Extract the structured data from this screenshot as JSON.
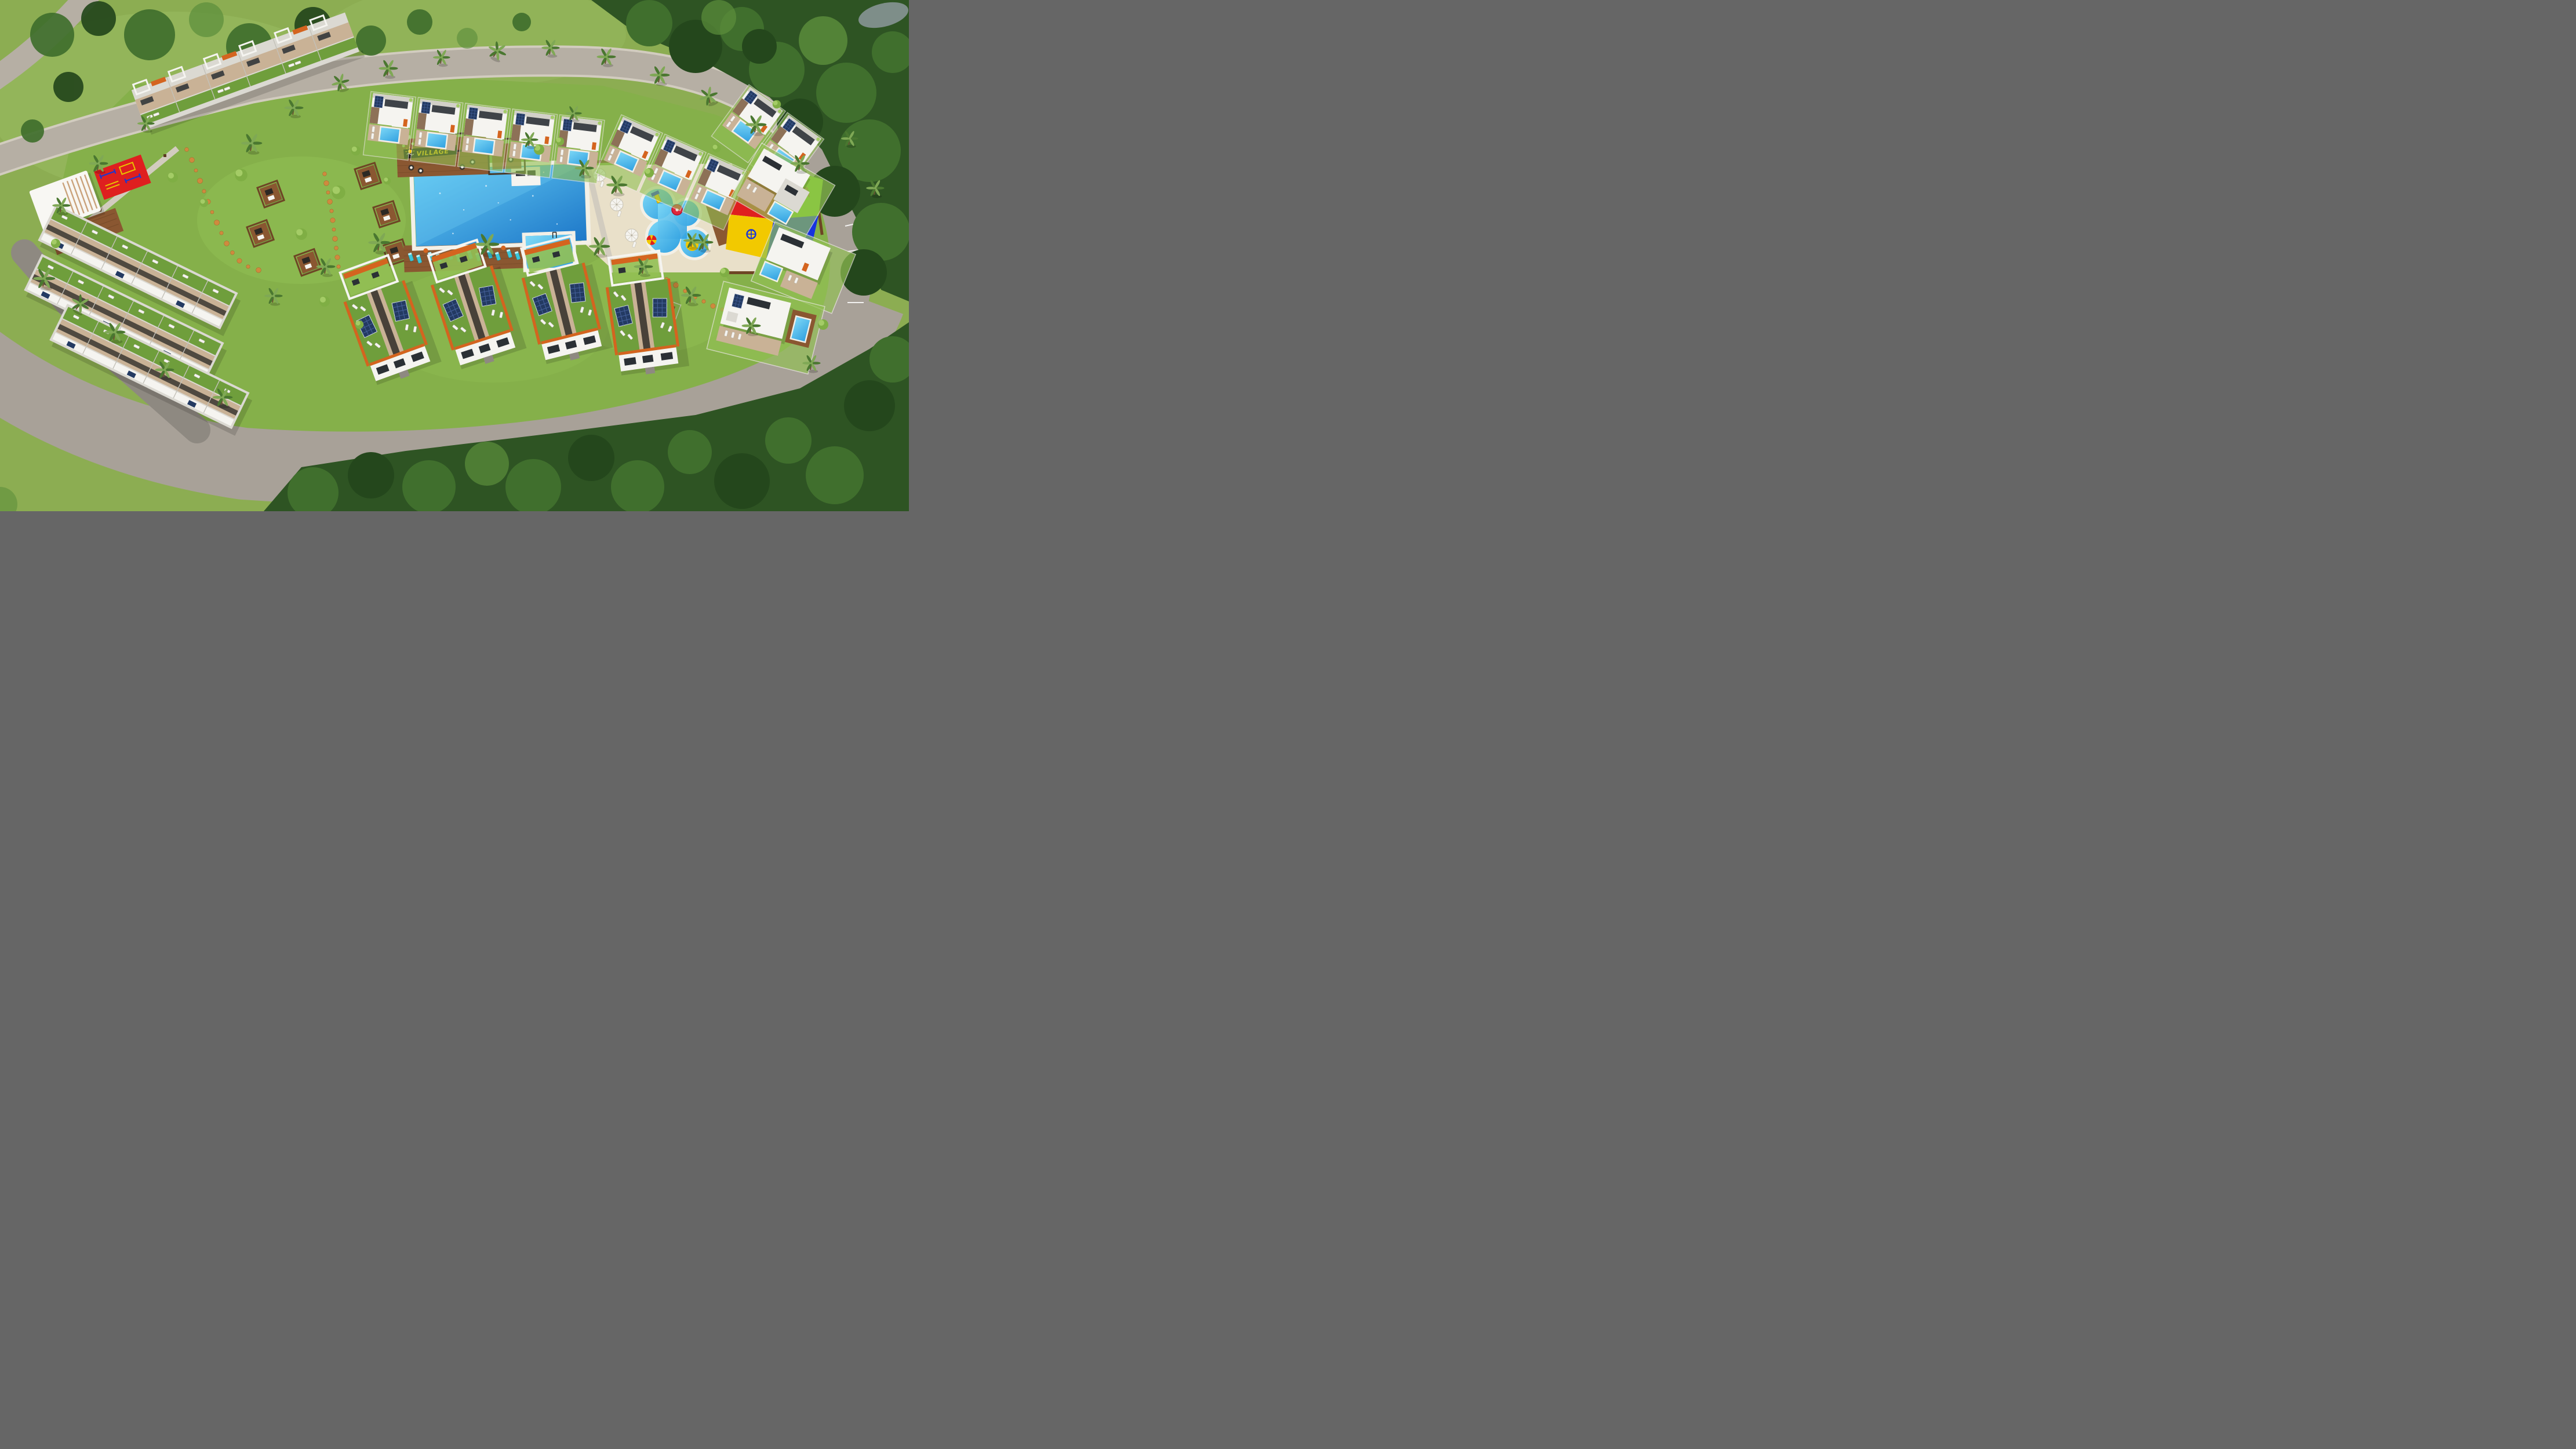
{
  "meta": {
    "kind": "aerial-3d-masterplan-render",
    "subject": "holiday village resort with townhouses, villas, communal pool, kids aqua zone and playground, ringed by a loop road and forest"
  },
  "signs": {
    "pool_bar": {
      "logo": "sun-script-logo",
      "text": "VILLAGE"
    }
  },
  "palette": {
    "meadow": "#8cad52",
    "meadowLight": "#9cbf63",
    "lawn": "#85b04a",
    "lawnBright": "#92c054",
    "forestDark": "#2e5423",
    "forestMid": "#406f2d",
    "forestLight": "#5d8f3c",
    "forestDeep": "#24471c",
    "road": "#b6afa4",
    "roadWide": "#a8a198",
    "roadDark": "#8e8981",
    "sidewalk": "#d2ccbf",
    "sand": "#e9e0c9",
    "poolDeep": "#1e78c9",
    "poolLight": "#63ccf4",
    "poolRim": "#f3f0e7",
    "wood": "#8a5731",
    "woodDark": "#6e4525",
    "deckLight": "#c9b296",
    "white": "#f5f4f0",
    "wall": "#dbd9d2",
    "glass": "#2b3035",
    "orange": "#d4641f",
    "solar": "#233a62",
    "greenRoof": "#6f9e3c",
    "tealLounger": "#3cc6d8",
    "playRed": "#df1f1f",
    "playYellow": "#f2c900",
    "playGreen": "#78d21e",
    "playBlue": "#1733df",
    "mushroom": "#e0273c",
    "logPath": "#cf8a3e",
    "palmDark": "#4a7730",
    "palmLight": "#7fa855",
    "trunk": "#6b5233",
    "bush1": "#7fae44",
    "bush2": "#a4cc66",
    "signBoard": "#17120e",
    "signText": "#f5c400",
    "pond": "#7e8e89"
  },
  "features": {
    "main_pool": {
      "shape": "rectangular with kids annex",
      "deck_loungers": 12,
      "white_umbrellas": 3,
      "swim_platform": true,
      "pool_bar": true
    },
    "kids_water_area": {
      "pool_shape": "freeform blob",
      "elements": [
        "mushroom-fountain",
        "mini-slide",
        "beach-umbrella",
        "palm-island"
      ],
      "surround": "sand"
    },
    "playground": {
      "surface_colors": [
        "#df1f1f",
        "#f2c900",
        "#78d21e",
        "#1733df"
      ],
      "equipment": [
        "wooden-climbing-frame",
        "red-slide",
        "swing-set",
        "climbing-dome",
        "spinner"
      ]
    },
    "outdoor_gym": {
      "mat_color": "#df1f1f",
      "pavilion": "white-canopy"
    },
    "housing": {
      "upper_left_townhouse_row_units": 6,
      "lower_left_terrace_rows": 3,
      "top_row_townhouses_with_private_pools": 10,
      "bottom_duplex_blocks": 4,
      "right_side_villas": 5,
      "rooftop_solar_panels": true,
      "roof_terraces_with_loungers": true
    },
    "landscape": {
      "garden_cabanas": 6,
      "log_slice_paths": true,
      "palm_trees": true,
      "perimeter_loop_road": true,
      "surrounding_forest": true,
      "pond_top_right": true,
      "roadside_parking_bays": true
    }
  }
}
